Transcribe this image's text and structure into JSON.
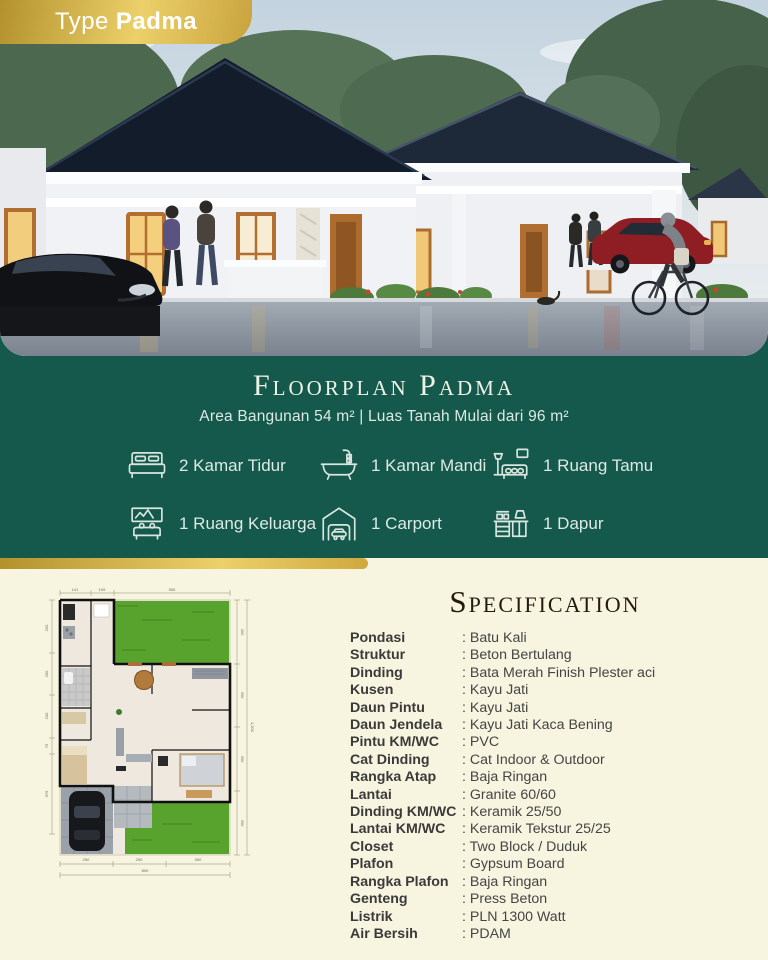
{
  "badge": {
    "type_label": "Type",
    "model_name": "Padma"
  },
  "floorplan_section": {
    "title": "Floorplan Padma",
    "subtitle": "Area Bangunan 54 m²  |  Luas Tanah Mulai dari 96 m²",
    "features": [
      {
        "icon": "bed-icon",
        "label": "2 Kamar Tidur"
      },
      {
        "icon": "bathtub-icon",
        "label": "1 Kamar Mandi"
      },
      {
        "icon": "sofa-icon",
        "label": "1 Ruang Tamu"
      },
      {
        "icon": "family-room-icon",
        "label": "1 Ruang Keluarga"
      },
      {
        "icon": "carport-icon",
        "label": "1 Carport"
      },
      {
        "icon": "kitchen-icon",
        "label": "1 Dapur"
      }
    ]
  },
  "specification": {
    "title": "Specification",
    "items": [
      {
        "label": "Pondasi",
        "value": "Batu Kali"
      },
      {
        "label": "Struktur",
        "value": "Beton Bertulang"
      },
      {
        "label": "Dinding",
        "value": "Bata Merah Finish Plester aci"
      },
      {
        "label": "Kusen",
        "value": "Kayu Jati"
      },
      {
        "label": "Daun Pintu",
        "value": "Kayu Jati"
      },
      {
        "label": "Daun Jendela",
        "value": "Kayu Jati Kaca Bening"
      },
      {
        "label": "Pintu KM/WC",
        "value": "PVC"
      },
      {
        "label": "Cat Dinding",
        "value": "Cat Indoor & Outdoor"
      },
      {
        "label": "Rangka Atap",
        "value": "Baja Ringan"
      },
      {
        "label": "Lantai",
        "value": "Granite 60/60"
      },
      {
        "label": "Dinding KM/WC",
        "value": "Keramik 25/50"
      },
      {
        "label": "Lantai KM/WC",
        "value": "Keramik Tekstur 25/25"
      },
      {
        "label": "Closet",
        "value": "Two Block / Duduk"
      },
      {
        "label": "Plafon",
        "value": "Gypsum Board"
      },
      {
        "label": "Rangka Plafon",
        "value": "Baja Ringan"
      },
      {
        "label": "Genteng",
        "value": "Press Beton"
      },
      {
        "label": "Listrik",
        "value": "PLN 1300 Watt"
      },
      {
        "label": "Air Bersih",
        "value": "PDAM"
      }
    ]
  },
  "floorplan": {
    "dims": {
      "top": [
        "141",
        "109",
        "550"
      ],
      "left": [
        "250",
        "200",
        "200",
        "75",
        "375"
      ],
      "right_inner": [
        "300",
        "300",
        "300",
        "300"
      ],
      "right_total": "1,200",
      "bottom": [
        "250",
        "250",
        "300"
      ],
      "bottom_total": "800"
    }
  },
  "colors": {
    "teal": "#14594c",
    "gold_dark": "#b3922c",
    "gold_light": "#ecd06a",
    "cream": "#f7f4df",
    "lawn_green": "#58a22e",
    "roof_navy": "#141d2c"
  }
}
